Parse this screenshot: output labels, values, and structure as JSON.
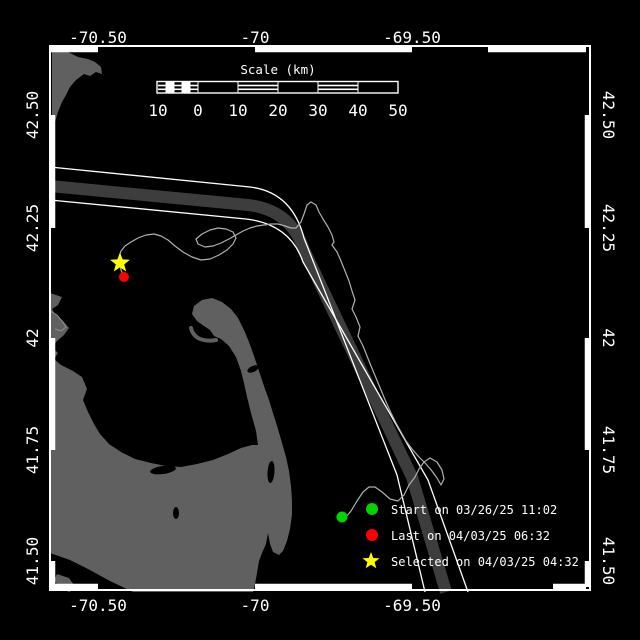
{
  "colors": {
    "background": "#000000",
    "frame": "#ffffff",
    "land": "#606060",
    "separation_zone": "#3d3d3d",
    "track": "#b0b0b0",
    "text": "#ffffff",
    "start_marker": "#00d400",
    "last_marker": "#ff0000",
    "selected_marker": "#ffff00"
  },
  "scalebar": {
    "title": "Scale (km)",
    "labels": [
      "10",
      "0",
      "10",
      "20",
      "30",
      "40",
      "50"
    ]
  },
  "axes": {
    "top": [
      "-70.50",
      "-70",
      "-69.50"
    ],
    "bottom": [
      "-70.50",
      "-70",
      "-69.50"
    ],
    "left": [
      "42.50",
      "42.25",
      "42",
      "41.75",
      "41.50"
    ],
    "right": [
      "42.50",
      "42.25",
      "42",
      "41.75",
      "41.50"
    ]
  },
  "legend": [
    {
      "marker": "start-dot",
      "label": "Start on 03/26/25 11:02"
    },
    {
      "marker": "last-dot",
      "label": "Last on 04/03/25 06:32"
    },
    {
      "marker": "selected-star",
      "label": "Selected on 04/03/25 04:32"
    }
  ]
}
